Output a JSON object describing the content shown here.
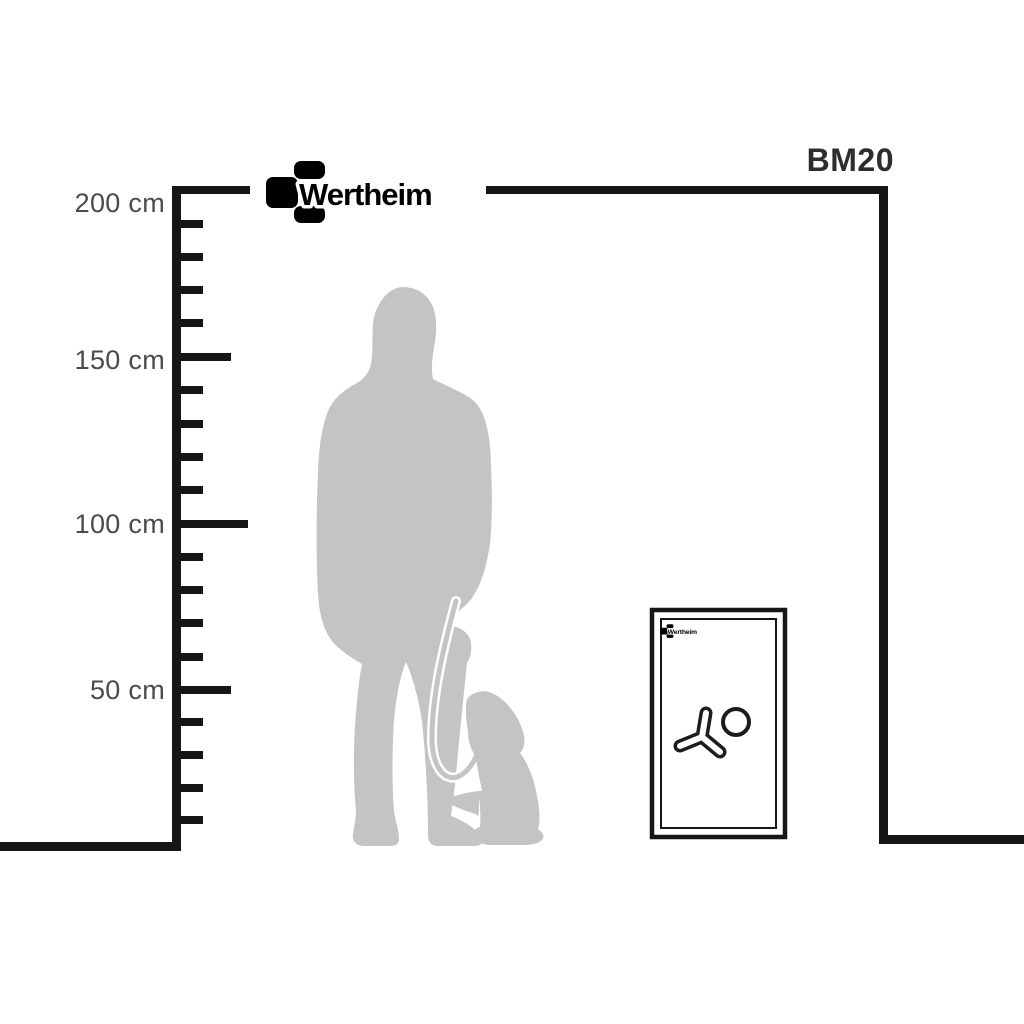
{
  "brand": {
    "name": "Wertheim"
  },
  "model": {
    "name": "BM20"
  },
  "ruler": {
    "unit": "cm",
    "max_value": 200,
    "minor_step": 10,
    "labels": [
      {
        "text": "200 cm",
        "value": 200
      },
      {
        "text": "150 cm",
        "value": 150
      },
      {
        "text": "100 cm",
        "value": 100
      },
      {
        "text": "50 cm",
        "value": 50
      }
    ]
  },
  "figures": {
    "person": "standing-woman-silhouette",
    "dog": "sitting-dog-silhouette",
    "safe": "wertheim-bm20-safe-front"
  },
  "colors": {
    "line": "#161616",
    "label_text": "#4b4b4d",
    "model_text": "#2d2d2f",
    "silhouette": "#c3c4c6",
    "brand": "#000000",
    "background": "#ffffff"
  }
}
